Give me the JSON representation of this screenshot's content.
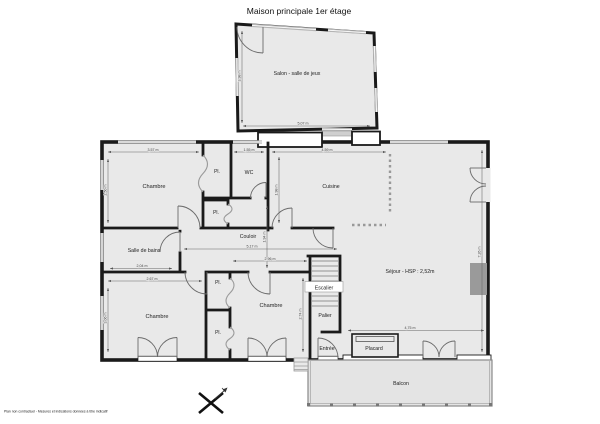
{
  "title": "Maison principale 1er étage",
  "footer": "Plan non contractuel - Mesures et indications données à titre indicatif",
  "colors": {
    "wall": "#1a1a1a",
    "room_fill": "#e9e9e9",
    "window": "#b5b5b5",
    "fireplace": "#9a9a9a",
    "balcony_fill": "#e4e4e4"
  },
  "rooms": {
    "salon": {
      "label": "Salon - salle de jeux"
    },
    "chambre_tl": {
      "label": "Chambre"
    },
    "pl1": {
      "label": "Pl."
    },
    "pl2": {
      "label": "Pl."
    },
    "pl3": {
      "label": "Pl."
    },
    "pl4": {
      "label": "Pl."
    },
    "wc": {
      "label": "WC"
    },
    "cuisine": {
      "label": "Cuisine"
    },
    "couloir": {
      "label": "Couloir"
    },
    "salle_de_bains": {
      "label": "Salle de bains"
    },
    "chambre_bl": {
      "label": "Chambre"
    },
    "chambre_br": {
      "label": "Chambre"
    },
    "sejour": {
      "label": "Séjour - HSP : 2,52m"
    },
    "escalier": {
      "label": "Escalier"
    },
    "palier": {
      "label": "Palier"
    },
    "entree": {
      "label": "Entrée"
    },
    "placard": {
      "label": "Placard"
    },
    "balcon": {
      "label": "Balcon"
    }
  },
  "dims": {
    "salon_w": "5,07 m",
    "salon_h": "3,98 m",
    "chambre_tl_w": "3,57 m",
    "chambre_tl_h": "2,50 m",
    "wc_w": "1,55 m",
    "cuisine_w": "4,59 m",
    "cuisine_h": "1,98 m",
    "couloir_w": "5,17 m",
    "couloir_h": "1,94 m",
    "sdb_w": "2,04 m",
    "chambre_bl_w": "2,67 m",
    "chambre_bl_h": "3,06 m",
    "chambre_br_w": "2,96 m",
    "chambre_br_h": "2,74 m",
    "sejour_w": "4,75 m",
    "sejour_h": "7,26 m"
  }
}
